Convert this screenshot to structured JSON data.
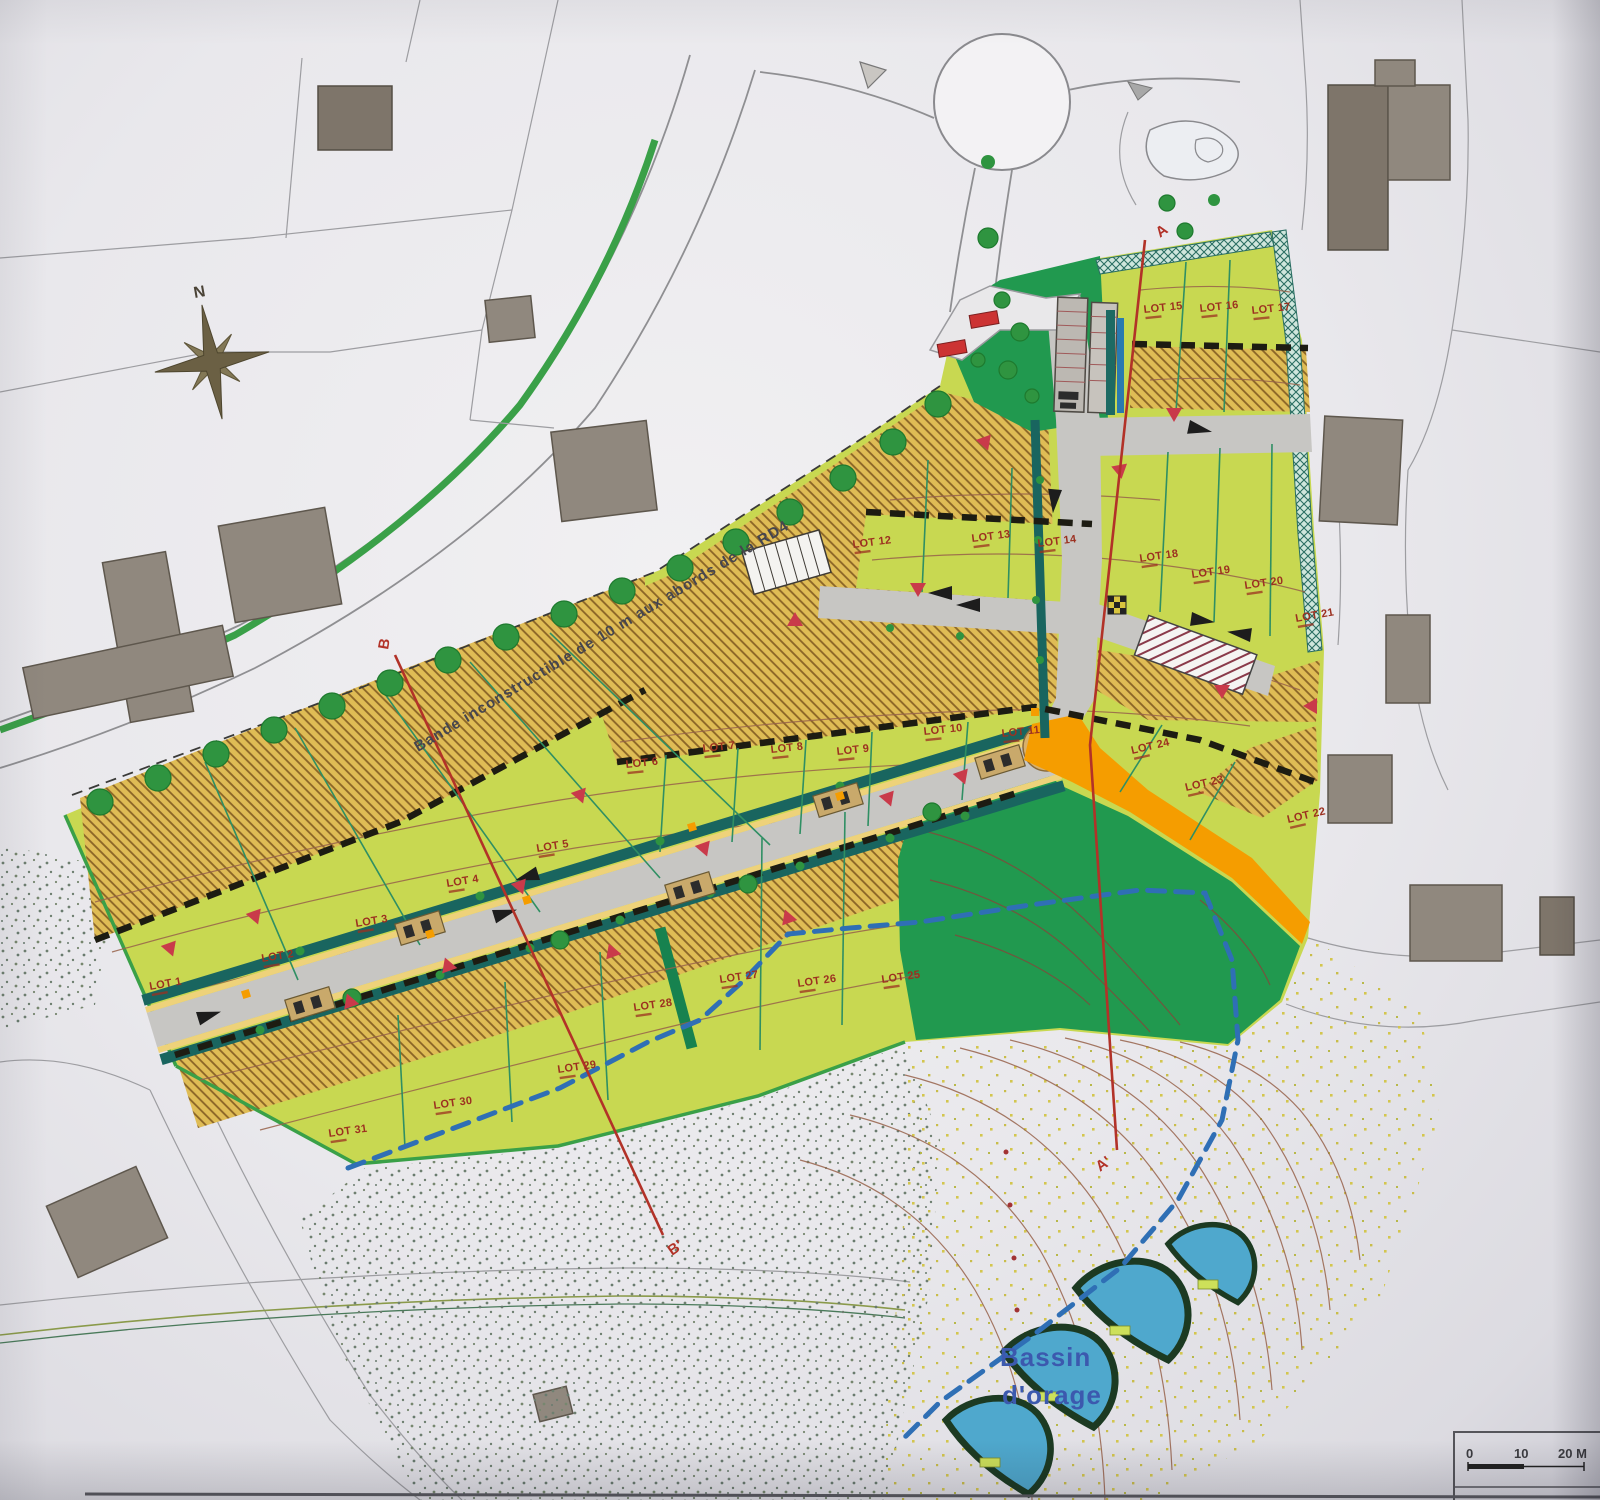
{
  "map": {
    "region_note": "Bande inconstructible de 10 m aux abords de la RD4",
    "compass": {
      "north_label": "N"
    },
    "storm_basin": {
      "line1": "Bassin",
      "line2": "d'orage"
    },
    "sections": {
      "a_start": "A",
      "a_end": "A'",
      "b_start": "B",
      "b_end": "B'"
    },
    "scale_bar": {
      "tick_0": "0",
      "tick_10": "10",
      "tick_20": "20 M"
    },
    "colors": {
      "lot_green": "#c8d851",
      "ochre": "#dfbc55",
      "dark_green": "#21994f",
      "road_grey": "#c7c6c3",
      "orange": "#f59d00",
      "basin_blue": "#4fa8cd",
      "section_red": "#b23228",
      "label_red": "#9c3020",
      "marker_red": "#c93a4a",
      "hedge_teal": "#1d6a63",
      "tree_green": "#2f9440",
      "contour_brown": "#96614a",
      "dashed_blue": "#2f6fb5",
      "basin_label_blue": "#3c59ae"
    },
    "lots": [
      {
        "label": "LOT 1",
        "x": 150,
        "y": 990,
        "r": -10
      },
      {
        "label": "LOT 2",
        "x": 262,
        "y": 962,
        "r": -9
      },
      {
        "label": "LOT 3",
        "x": 356,
        "y": 927,
        "r": -9
      },
      {
        "label": "LOT 4",
        "x": 447,
        "y": 887,
        "r": -9
      },
      {
        "label": "LOT 5",
        "x": 537,
        "y": 852,
        "r": -9
      },
      {
        "label": "LOT 6",
        "x": 626,
        "y": 768,
        "r": -6
      },
      {
        "label": "LOT 7",
        "x": 703,
        "y": 752,
        "r": -6
      },
      {
        "label": "LOT 8",
        "x": 771,
        "y": 753,
        "r": -6
      },
      {
        "label": "LOT 9",
        "x": 837,
        "y": 755,
        "r": -6
      },
      {
        "label": "LOT 10",
        "x": 924,
        "y": 735,
        "r": -6
      },
      {
        "label": "LOT 11",
        "x": 1002,
        "y": 737,
        "r": -6
      },
      {
        "label": "LOT 12",
        "x": 853,
        "y": 548,
        "r": -7
      },
      {
        "label": "LOT 13",
        "x": 972,
        "y": 542,
        "r": -7
      },
      {
        "label": "LOT 14",
        "x": 1038,
        "y": 547,
        "r": -7
      },
      {
        "label": "LOT 15",
        "x": 1144,
        "y": 313,
        "r": -6
      },
      {
        "label": "LOT 16",
        "x": 1200,
        "y": 312,
        "r": -6
      },
      {
        "label": "LOT 17",
        "x": 1252,
        "y": 314,
        "r": -6
      },
      {
        "label": "LOT 18",
        "x": 1140,
        "y": 562,
        "r": -8
      },
      {
        "label": "LOT 19",
        "x": 1192,
        "y": 578,
        "r": -8
      },
      {
        "label": "LOT 20",
        "x": 1245,
        "y": 589,
        "r": -8
      },
      {
        "label": "LOT 21",
        "x": 1296,
        "y": 622,
        "r": -10
      },
      {
        "label": "LOT 22",
        "x": 1288,
        "y": 823,
        "r": -13
      },
      {
        "label": "LOT 23",
        "x": 1186,
        "y": 791,
        "r": -13
      },
      {
        "label": "LOT 24",
        "x": 1132,
        "y": 754,
        "r": -13
      },
      {
        "label": "LOT 25",
        "x": 882,
        "y": 983,
        "r": -8
      },
      {
        "label": "LOT 26",
        "x": 798,
        "y": 987,
        "r": -8
      },
      {
        "label": "LOT 27",
        "x": 720,
        "y": 983,
        "r": -8
      },
      {
        "label": "LOT 28",
        "x": 634,
        "y": 1011,
        "r": -8
      },
      {
        "label": "LOT 29",
        "x": 558,
        "y": 1073,
        "r": -8
      },
      {
        "label": "LOT 30",
        "x": 434,
        "y": 1109,
        "r": -8
      },
      {
        "label": "LOT 31",
        "x": 329,
        "y": 1137,
        "r": -8
      }
    ]
  }
}
